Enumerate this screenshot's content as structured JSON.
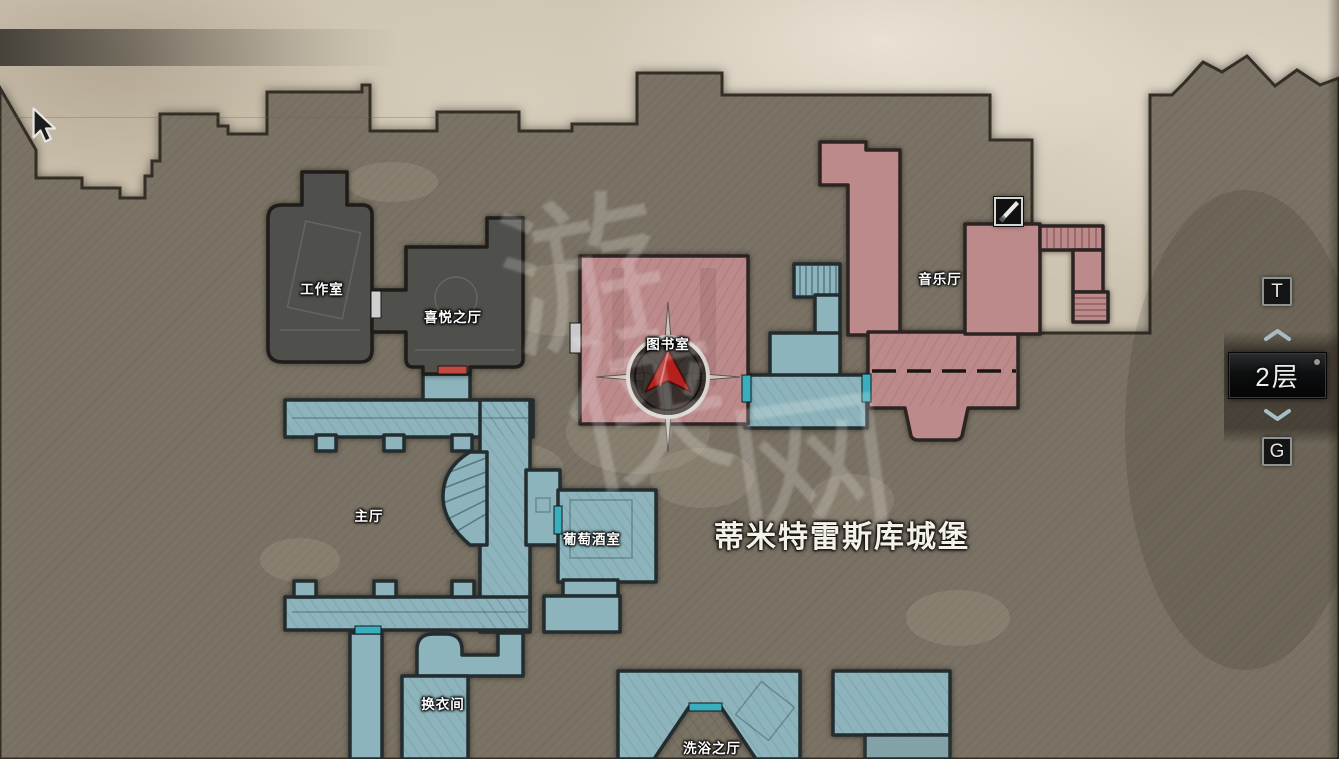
{
  "map": {
    "title": "蒂米特雷斯库城堡",
    "rooms": [
      {
        "label": "工作室",
        "state": "inactive"
      },
      {
        "label": "喜悦之厅",
        "state": "inactive"
      },
      {
        "label": "图书室",
        "state": "unexplored"
      },
      {
        "label": "音乐厅",
        "state": "unexplored"
      },
      {
        "label": "主厅",
        "state": "explored"
      },
      {
        "label": "葡萄酒室",
        "state": "explored"
      },
      {
        "label": "换衣间",
        "state": "explored"
      },
      {
        "label": "洗浴之厅",
        "state": "explored"
      }
    ],
    "markers": {
      "item_icon": "dagger-icon",
      "player_marker": "compass-red-arrow"
    },
    "watermark": {
      "chars": [
        "游",
        "侠",
        "网"
      ]
    }
  },
  "floor_selector": {
    "up_key_hint": "T",
    "current_floor": "2层",
    "down_key_hint": "G",
    "up_icon": "chevron-up",
    "down_icon": "chevron-down"
  },
  "colors": {
    "explored_room": "#8db4bc",
    "unexplored_room": "#bc8a8b",
    "inactive_room": "#4f4f4c",
    "door_highlight": "#38aebe",
    "door_red": "#c04a42",
    "door_white": "#cfcfcf",
    "player_marker": "#b5201d",
    "terrain": "#7a7264",
    "parchment": "#cdc3b1"
  }
}
